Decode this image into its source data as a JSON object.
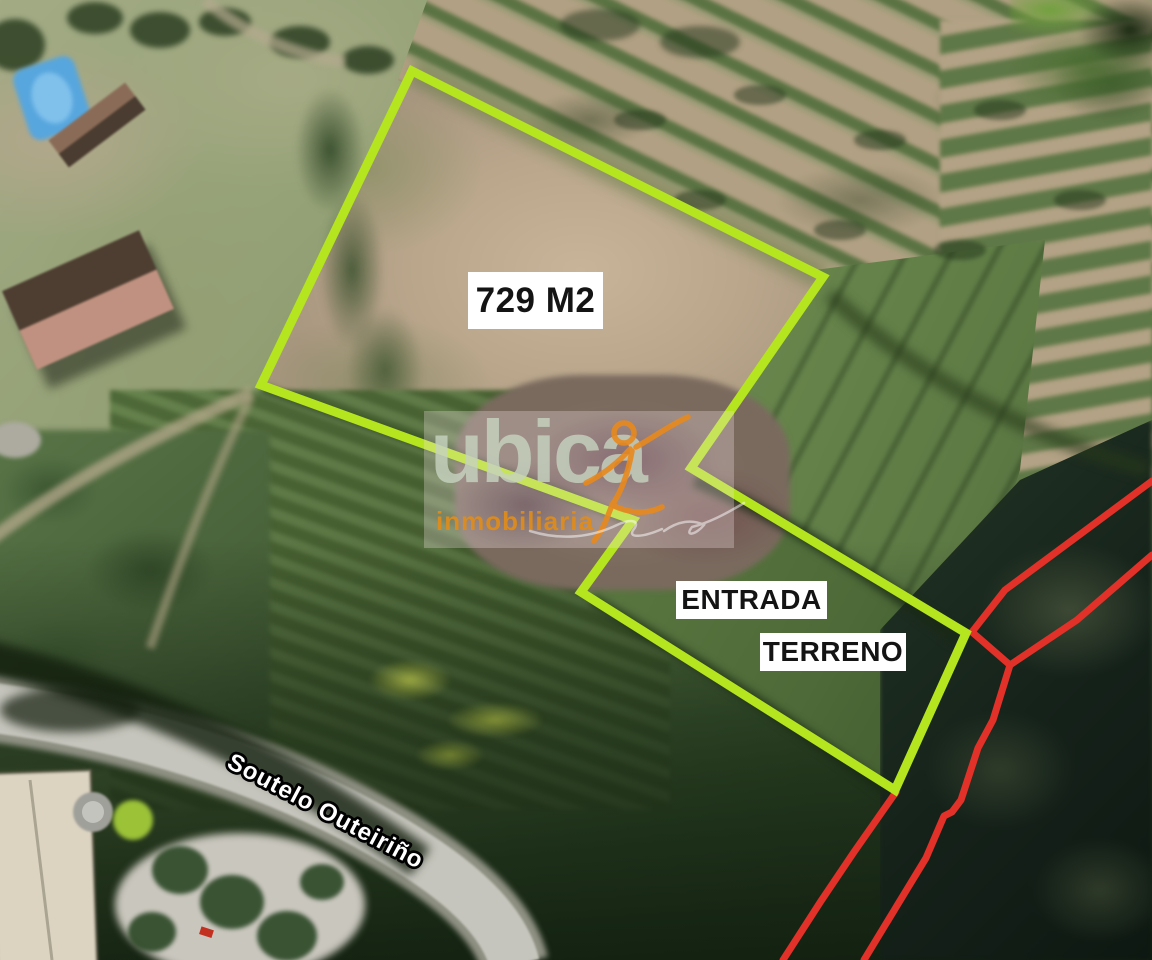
{
  "map": {
    "labels": {
      "area": "729 M2",
      "entrance_line1": "ENTRADA",
      "entrance_line2": "TERRENO",
      "road_name": "Soutelo Outeiriño"
    },
    "plot": {
      "outline_color": "#b5e51e",
      "polygon_points": "412,71 823,277 691,468 966,633 895,790 581,592 633,520 261,385"
    },
    "boundary_lines": {
      "color": "#e23128",
      "line_a_points": "1152,481 1005,590 972,632 1010,665",
      "line_b_points": "1152,555 1077,620 1010,665",
      "line_c_points": "1010,665 993,720 978,748 961,800 952,812 944,816 926,858 898,904 864,960",
      "line_d_points": "896,792 854,852 821,901 783,960"
    }
  },
  "watermark": {
    "brand": "ubica",
    "tagline": "inmobiliaria",
    "brand_color": "#c6d2be",
    "tagline_color": "#e08c1a",
    "figure_color": "#e8891d"
  }
}
